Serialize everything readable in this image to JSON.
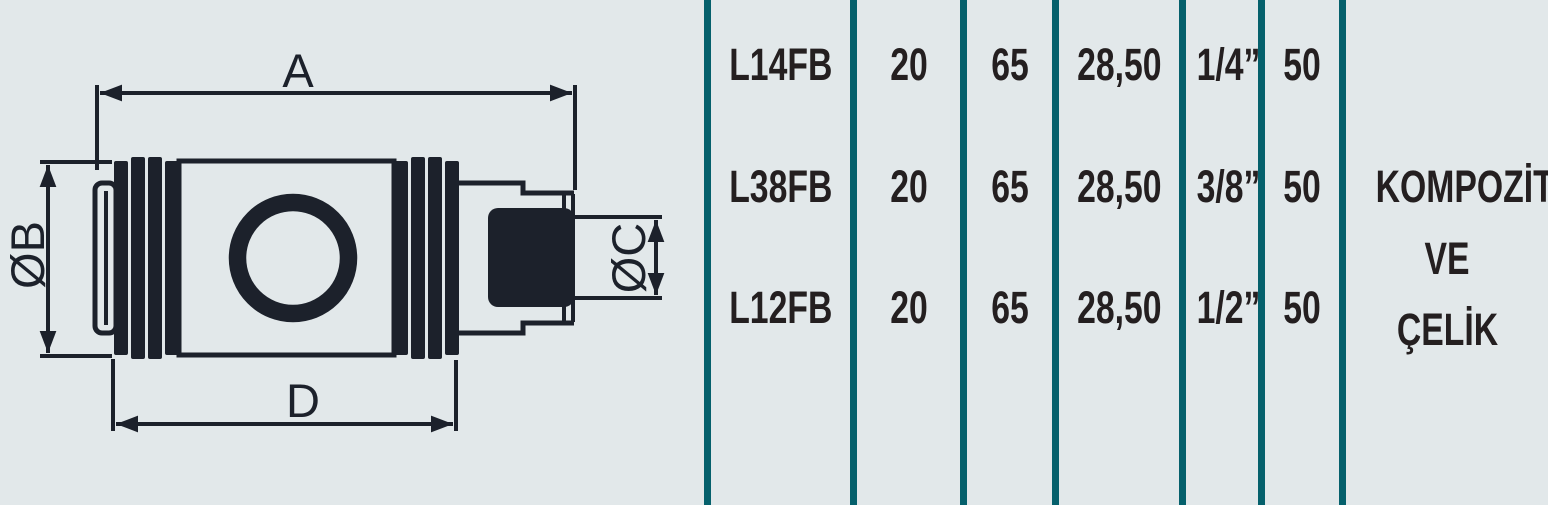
{
  "colors": {
    "background": "#e2e8ea",
    "divider_teal": "#05606c",
    "text_dark": "#241f20",
    "drawing_line": "#1c212b"
  },
  "drawing": {
    "labels": {
      "a": "A",
      "b": "ØB",
      "c": "ØC",
      "d": "D"
    }
  },
  "table": {
    "rows": [
      {
        "part": "L14FB",
        "values": [
          "20",
          "65",
          "28,50",
          "1/4”",
          "50"
        ]
      },
      {
        "part": "L38FB",
        "values": [
          "20",
          "65",
          "28,50",
          "3/8”",
          "50"
        ]
      },
      {
        "part": "L12FB",
        "values": [
          "20",
          "65",
          "28,50",
          "1/2”",
          "50"
        ]
      }
    ],
    "material_lines": [
      "KOMPOZİT",
      "VE",
      "ÇELİK"
    ]
  }
}
